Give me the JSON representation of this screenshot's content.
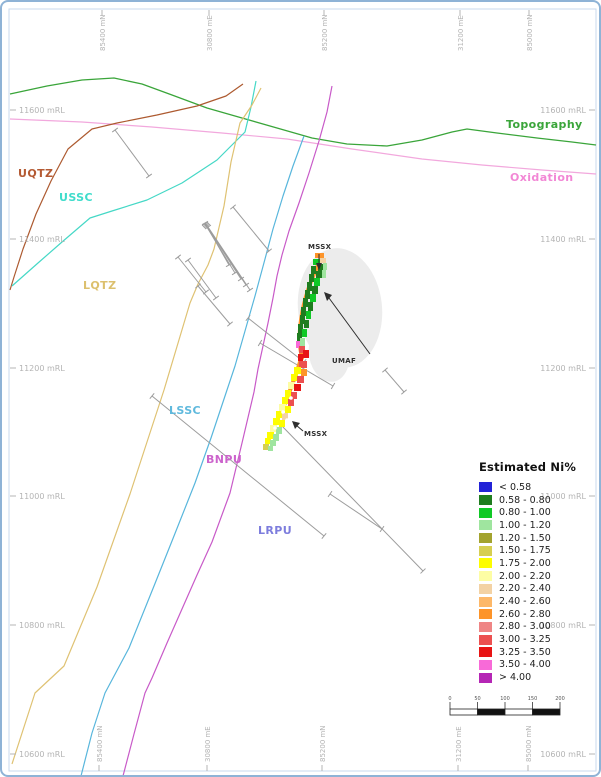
{
  "axes": {
    "top": [
      {
        "label": "85400 mN",
        "x": 100
      },
      {
        "label": "30800 mE",
        "x": 207
      },
      {
        "label": "85200 mN",
        "x": 322
      },
      {
        "label": "31200 mE",
        "x": 458
      },
      {
        "label": "85000 mN",
        "x": 527
      }
    ],
    "bottom": [
      {
        "label": "85400 mN",
        "x": 97
      },
      {
        "label": "30800 mE",
        "x": 205
      },
      {
        "label": "85200 mN",
        "x": 320
      },
      {
        "label": "31200 mE",
        "x": 456
      },
      {
        "label": "85000 mN",
        "x": 526
      }
    ],
    "left": [
      {
        "label": "11600 mRL",
        "y": 108
      },
      {
        "label": "11400 mRL",
        "y": 237
      },
      {
        "label": "11200 mRL",
        "y": 366
      },
      {
        "label": "11000 mRL",
        "y": 494
      },
      {
        "label": "10800 mRL",
        "y": 623
      },
      {
        "label": "10600 mRL",
        "y": 752
      }
    ],
    "right": [
      {
        "label": "11600 mRL",
        "y": 108
      },
      {
        "label": "11400 mRL",
        "y": 237
      },
      {
        "label": "11200 mRL",
        "y": 366
      },
      {
        "label": "11000 mRL",
        "y": 494
      },
      {
        "label": "10800 mRL",
        "y": 623
      },
      {
        "label": "10600 mRL",
        "y": 752
      }
    ]
  },
  "zone_labels": [
    {
      "text": "UQTZ",
      "x": 16,
      "y": 165,
      "color": "#b45a33"
    },
    {
      "text": "USSC",
      "x": 57,
      "y": 189,
      "color": "#3fdccb"
    },
    {
      "text": "LQTZ",
      "x": 81,
      "y": 277,
      "color": "#dcc06e"
    },
    {
      "text": "LSSC",
      "x": 167,
      "y": 402,
      "color": "#5fb9dd"
    },
    {
      "text": "BNPU",
      "x": 204,
      "y": 451,
      "color": "#cc63cc"
    },
    {
      "text": "LRPU",
      "x": 256,
      "y": 522,
      "color": "#7d7ddd"
    },
    {
      "text": "Topography",
      "x": 504,
      "y": 116,
      "color": "#3aa53a"
    },
    {
      "text": "Oxidation",
      "x": 508,
      "y": 169,
      "color": "#f287d5"
    }
  ],
  "annotations": [
    {
      "text": "MSSX",
      "x": 306,
      "y": 241
    },
    {
      "text": "UMAF",
      "x": 330,
      "y": 355
    },
    {
      "text": "MSSX",
      "x": 302,
      "y": 428
    }
  ],
  "legend": {
    "title": "Estimated Ni%",
    "entries": [
      {
        "label": "< 0.58",
        "color": "#2323d7"
      },
      {
        "label": "0.58 - 0.80",
        "color": "#1f7d1f"
      },
      {
        "label": "0.80 - 1.00",
        "color": "#10c926"
      },
      {
        "label": "1.00 - 1.20",
        "color": "#9fe59f"
      },
      {
        "label": "1.20 - 1.50",
        "color": "#a3a32e"
      },
      {
        "label": "1.50 - 1.75",
        "color": "#d6cf52"
      },
      {
        "label": "1.75 - 2.00",
        "color": "#fdfd00"
      },
      {
        "label": "2.00 - 2.20",
        "color": "#fdfda4"
      },
      {
        "label": "2.20 - 2.40",
        "color": "#f3d2a4"
      },
      {
        "label": "2.40 - 2.60",
        "color": "#fdb869"
      },
      {
        "label": "2.60 - 2.80",
        "color": "#fd9429"
      },
      {
        "label": "2.80 - 3.00",
        "color": "#ef8585"
      },
      {
        "label": "3.00 - 3.25",
        "color": "#ec5050"
      },
      {
        "label": "3.25 - 3.50",
        "color": "#e81414"
      },
      {
        "label": "3.50 - 4.00",
        "color": "#f86ad8"
      },
      {
        "label": "> 4.00",
        "color": "#b526b5"
      }
    ]
  },
  "scale_bar": {
    "tick_labels": [
      "0",
      "50",
      "100",
      "150",
      "200"
    ]
  },
  "line_colors": {
    "topography": "#3aa53a",
    "oxidation": "#f2a8dd",
    "uqtz": "#ad5a30",
    "ussc": "#45d8c6",
    "lqtz": "#dfc273",
    "lssc": "#58b6dc",
    "bnpu": "#c85ac8",
    "drill": "#9c9c9c",
    "annotation": "#2e2e2e",
    "axis_text": "#b4b4b4",
    "frame": "#c9daec",
    "outer_border": "#8fb3d6",
    "influence_zone": "#ececec"
  }
}
